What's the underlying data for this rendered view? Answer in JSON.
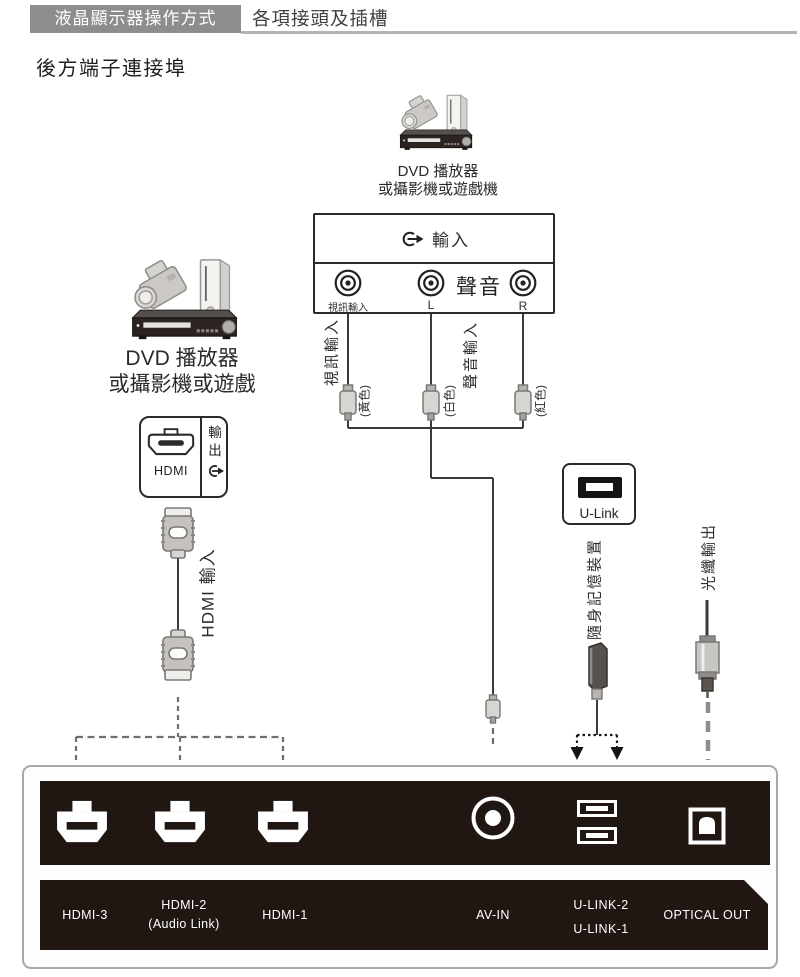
{
  "header": {
    "tab_label": "液晶顯示器操作方式",
    "section_label": "各項接頭及插槽"
  },
  "title": "後方端子連接埠",
  "devices": {
    "top": {
      "line1": "DVD 播放器",
      "line2": "或攝影機或遊戲機"
    },
    "left": {
      "line1": "DVD 播放器",
      "line2": "或攝影機或遊戲"
    }
  },
  "av_box": {
    "input_label": "輸入",
    "audio_label": "聲音",
    "video_label": "視訊輸入",
    "left_channel": "L",
    "right_channel": "R"
  },
  "hdmi_box": {
    "port_label": "HDMI",
    "output_label": "輸出"
  },
  "ulink_box": {
    "label": "U-Link"
  },
  "annotations": {
    "video_input": "視訊輸入",
    "audio_input": "聲音輸入",
    "yellow": "(黃色)",
    "white": "(白色)",
    "red": "(紅色)",
    "hdmi_input": "HDMI 輸入",
    "usb_device": "隨身記憶裝置",
    "optical_output": "光纖輸出"
  },
  "rear_panel": {
    "ports": [
      {
        "id": "hdmi-3",
        "label": "HDMI-3"
      },
      {
        "id": "hdmi-2",
        "label": "HDMI-2",
        "sublabel": "(Audio Link)"
      },
      {
        "id": "hdmi-1",
        "label": "HDMI-1"
      },
      {
        "id": "av-in",
        "label": "AV-IN"
      },
      {
        "id": "u-link",
        "label": "U-LINK-2",
        "sublabel": "U-LINK-1"
      },
      {
        "id": "optical-out",
        "label": "OPTICAL OUT"
      }
    ]
  },
  "colors": {
    "header_bg": "#8d8d8d",
    "panel_dark": "#201713",
    "line": "#3a3a3a"
  }
}
